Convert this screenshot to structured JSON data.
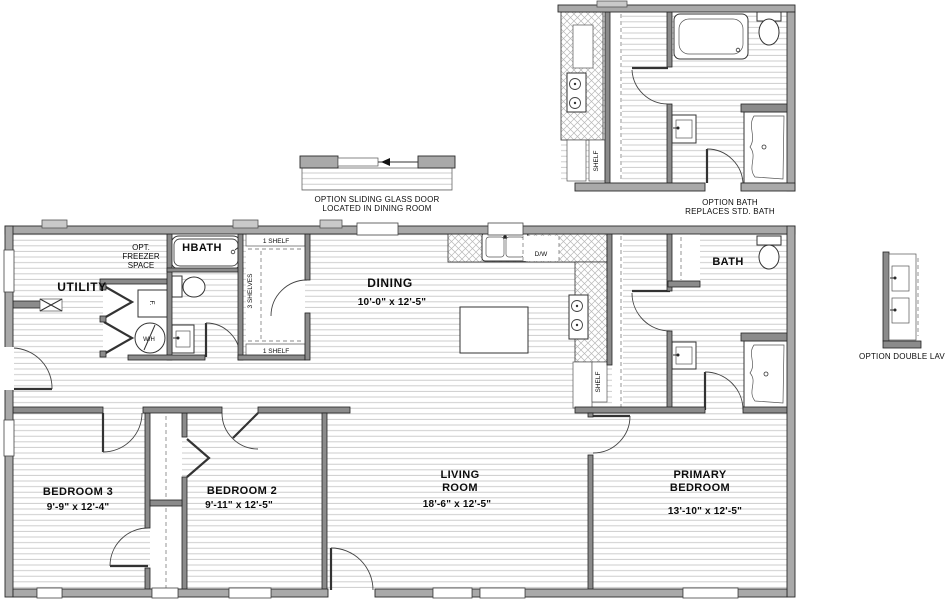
{
  "plan": {
    "rooms": {
      "utility": {
        "label": "UTILITY"
      },
      "hbath": {
        "label": "HBATH"
      },
      "dining": {
        "label": "DINING",
        "dims": "10'-0\"  x  12'-5\""
      },
      "bath": {
        "label": "BATH"
      },
      "bedroom3": {
        "label": "BEDROOM 3",
        "dims": "9'-9\"  x  12'-4\""
      },
      "bedroom2": {
        "label": "BEDROOM 2",
        "dims": "9'-11\"  x  12'-5\""
      },
      "living_room": {
        "line1": "LIVING",
        "line2": "ROOM",
        "dims": "18'-6\"  x  12'-5\""
      },
      "primary_bedroom": {
        "line1": "PRIMARY",
        "line2": "BEDROOM",
        "dims": "13'-10\"  x  12'-5\""
      }
    },
    "labels": {
      "opt_freezer": [
        "OPT.",
        "FREEZER",
        "SPACE"
      ],
      "washer": "F.",
      "water_heater": "W/H",
      "shelf_top": "1 SHELF",
      "shelves_vertical": "3 SHELVES",
      "shelf_bottom": "1 SHELF",
      "dishwasher": "D/W",
      "kitchen_shelf": "SHELF"
    }
  },
  "details": {
    "sliding_door": {
      "caption": [
        "OPTION SLIDING GLASS DOOR",
        "LOCATED IN DINING ROOM"
      ]
    },
    "option_bath": {
      "caption": [
        "OPTION BATH",
        "REPLACES STD. BATH"
      ],
      "shelf": "SHELF"
    },
    "double_lav": {
      "caption": "OPTION DOUBLE LAV"
    }
  },
  "colors": {
    "exterior_wall": "#a9a9a9",
    "interior_wall": "#8b8b8b",
    "floor_line": "#c8c8c8",
    "counter_hatch": "#b8b8b8",
    "text": "#0c0c0c"
  }
}
